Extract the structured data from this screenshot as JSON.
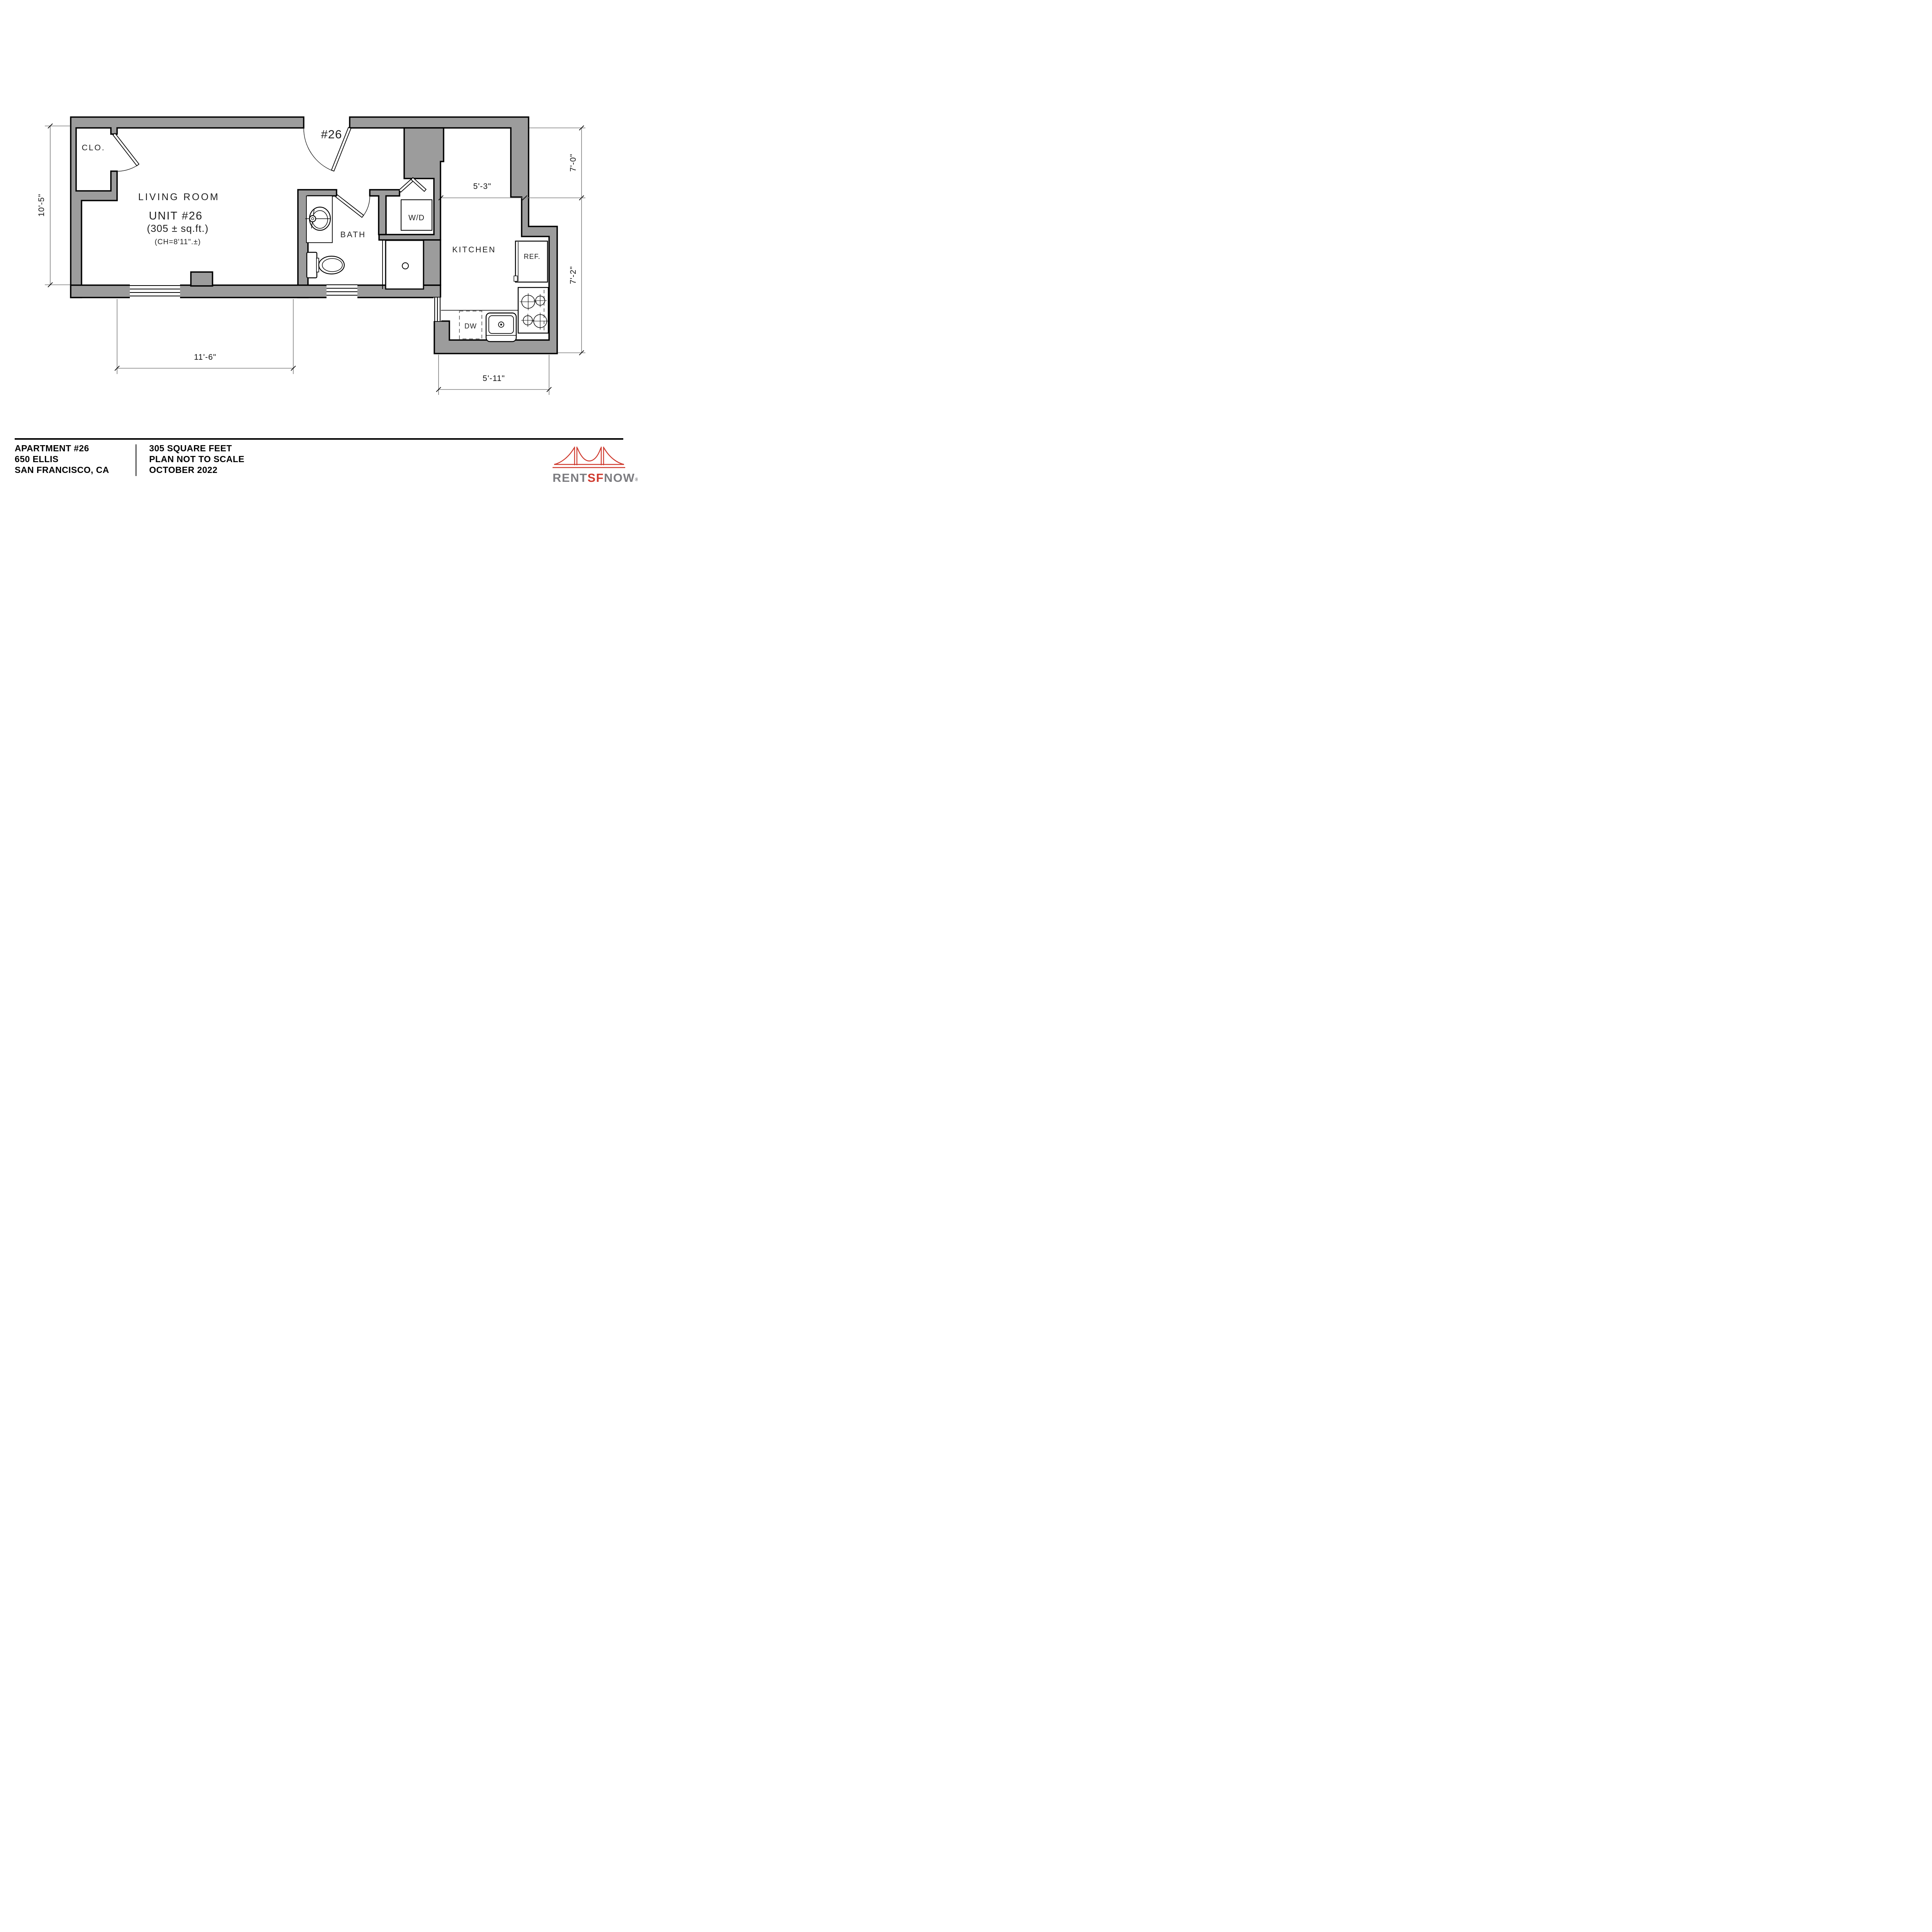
{
  "plan": {
    "entry_label": "#26",
    "rooms": {
      "closet": "CLO.",
      "living": "LIVING  ROOM",
      "unit": "UNIT  #26",
      "area": "(305  ±  sq.ft.)",
      "ceiling": "(CH=8'11\".±)",
      "bath": "BATH",
      "wd": "W/D",
      "kitchen": "KITCHEN",
      "ref": "REF.",
      "dw": "DW"
    },
    "dims": {
      "left": "10'-5\"",
      "living_bottom": "11'-6\"",
      "kitchen_top": "5'-3\"",
      "right_upper": "7'-0\"",
      "right_lower": "7'-2\"",
      "kitchen_bottom": "5'-11\""
    }
  },
  "title": {
    "apartment": "APARTMENT #26",
    "address": "650 ELLIS",
    "city": "SAN FRANCISCO, CA",
    "area": "305 SQUARE FEET",
    "scale": "PLAN NOT TO SCALE",
    "date": "OCTOBER 2022"
  },
  "logo": {
    "rent": "RENT",
    "sf": "SF",
    "now": "NOW",
    "reg": "®"
  },
  "colors": {
    "wall": "#9c9c9c",
    "dim": "#7f7f7f",
    "red": "#cf3a2e",
    "lgray": "#7c7c80"
  }
}
